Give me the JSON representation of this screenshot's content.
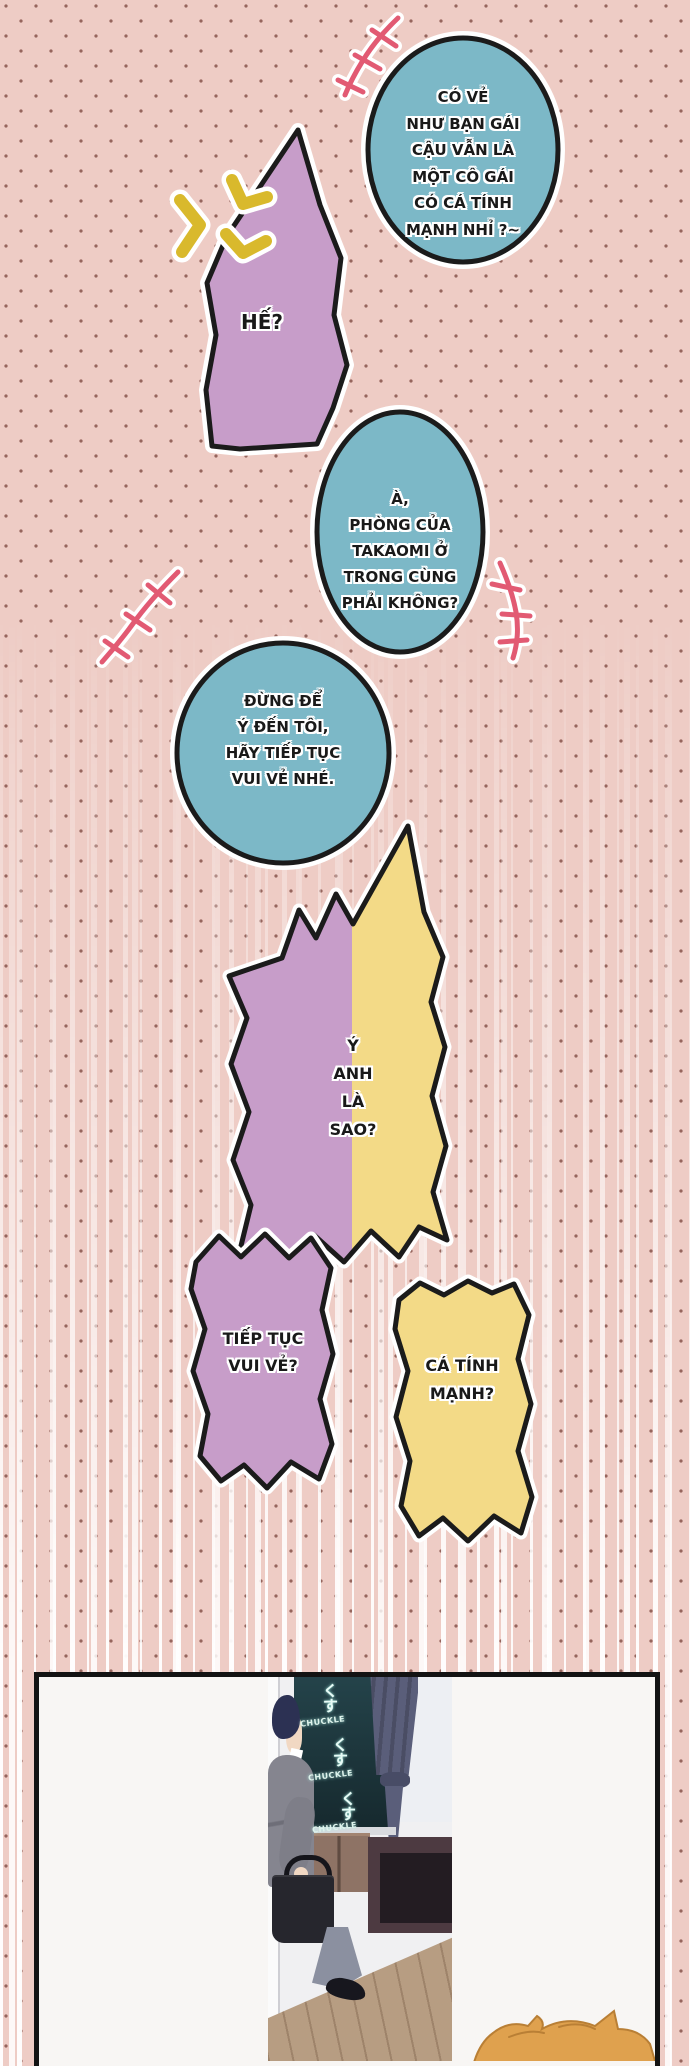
{
  "bubbles": [
    {
      "id": "shock-blue-top",
      "lines": [
        "CÓ VẺ",
        "NHƯ BẠN GÁI",
        "CẬU VẪN LÀ",
        "MỘT CÔ GÁI",
        "CÓ CÁ TÍNH",
        "MẠNH NHỈ ?~"
      ]
    },
    {
      "id": "purple-he",
      "lines": [
        "HẾ?"
      ]
    },
    {
      "id": "blue-room-question",
      "lines": [
        "À,",
        "PHÒNG CỦA",
        "TAKAOMI Ở",
        "TRONG CÙNG",
        "PHẢI KHÔNG?"
      ]
    },
    {
      "id": "blue-dont-mind",
      "lines": [
        "ĐỪNG ĐỂ",
        "Ý ĐẾN TÔI,",
        "HÃY TIẾP TỤC",
        "VUI VẺ NHÉ."
      ]
    },
    {
      "id": "split-what-do-you-mean",
      "lines": [
        "Ý",
        "ANH",
        "LÀ",
        "SAO?"
      ]
    },
    {
      "id": "purple-echo",
      "lines": [
        "TIẾP TỤC",
        "VUI VẺ?"
      ]
    },
    {
      "id": "yellow-echo",
      "lines": [
        "CÁ TÍNH",
        "MẠNH?"
      ]
    }
  ],
  "sfx": {
    "items": [
      {
        "jp": "くす",
        "en": "CHUCKLE"
      },
      {
        "jp": "くす",
        "en": "CHUCKLE"
      },
      {
        "jp": "くす",
        "en": "CHUCKLE"
      }
    ]
  },
  "colors": {
    "background_pink": "#eeccc5",
    "dot_brown": "#96655d",
    "bubble_blue": "#7cb8c7",
    "bubble_purple": "#c79dc9",
    "bubble_yellow": "#f3da87",
    "anger_yellow": "#d9b92c",
    "stitch_pink": "#e25a73",
    "outline_black": "#1b1b1b",
    "speedline_white": "#ffffff",
    "hair_orange": "#dfa14e"
  }
}
